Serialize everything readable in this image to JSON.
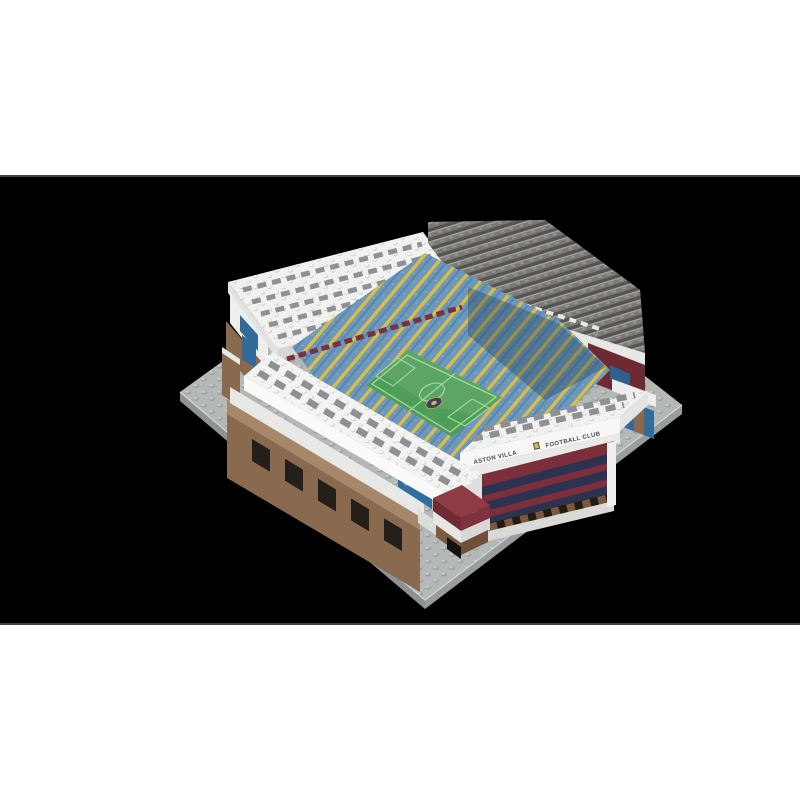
{
  "scene": {
    "description": "Letterboxed 3D render of a mini brick (BRXLZ-style) model of Aston Villa's Villa Park stadium on a gray stud baseplate against a black background",
    "frame": {
      "background": "#000000",
      "page_background": "#ffffff",
      "band_top_height": 175,
      "band_height": 450
    },
    "facade": {
      "left_text": "ASTON VILLA",
      "right_text": "FOOTBALL CLUB",
      "crest": "aston-villa-crest"
    },
    "palette": {
      "baseplate": "#b4b9b7",
      "baseplate_edge": "#8e9391",
      "white_brick": "#f2f2f0",
      "white_brick_shade": "#d7d7d5",
      "roof_tile_gray": "#8e9092",
      "terrace_gray": "#7b7977",
      "terrace_gray_dark": "#565350",
      "seat_blue": "#6c98bc",
      "seat_yellow": "#d9bd44",
      "claret": "#7a2f3a",
      "claret_bright": "#8e3b44",
      "navy_stripe": "#2c3350",
      "pitch_green": "#4f9e58",
      "pitch_line": "#a5d6a0",
      "wall_brown": "#8a6a4f",
      "wall_brown_light": "#a6876a",
      "glass_blue": "#336a99",
      "glass_blue_light": "#7fb3d8",
      "crest_gold": "#d4b545"
    }
  }
}
